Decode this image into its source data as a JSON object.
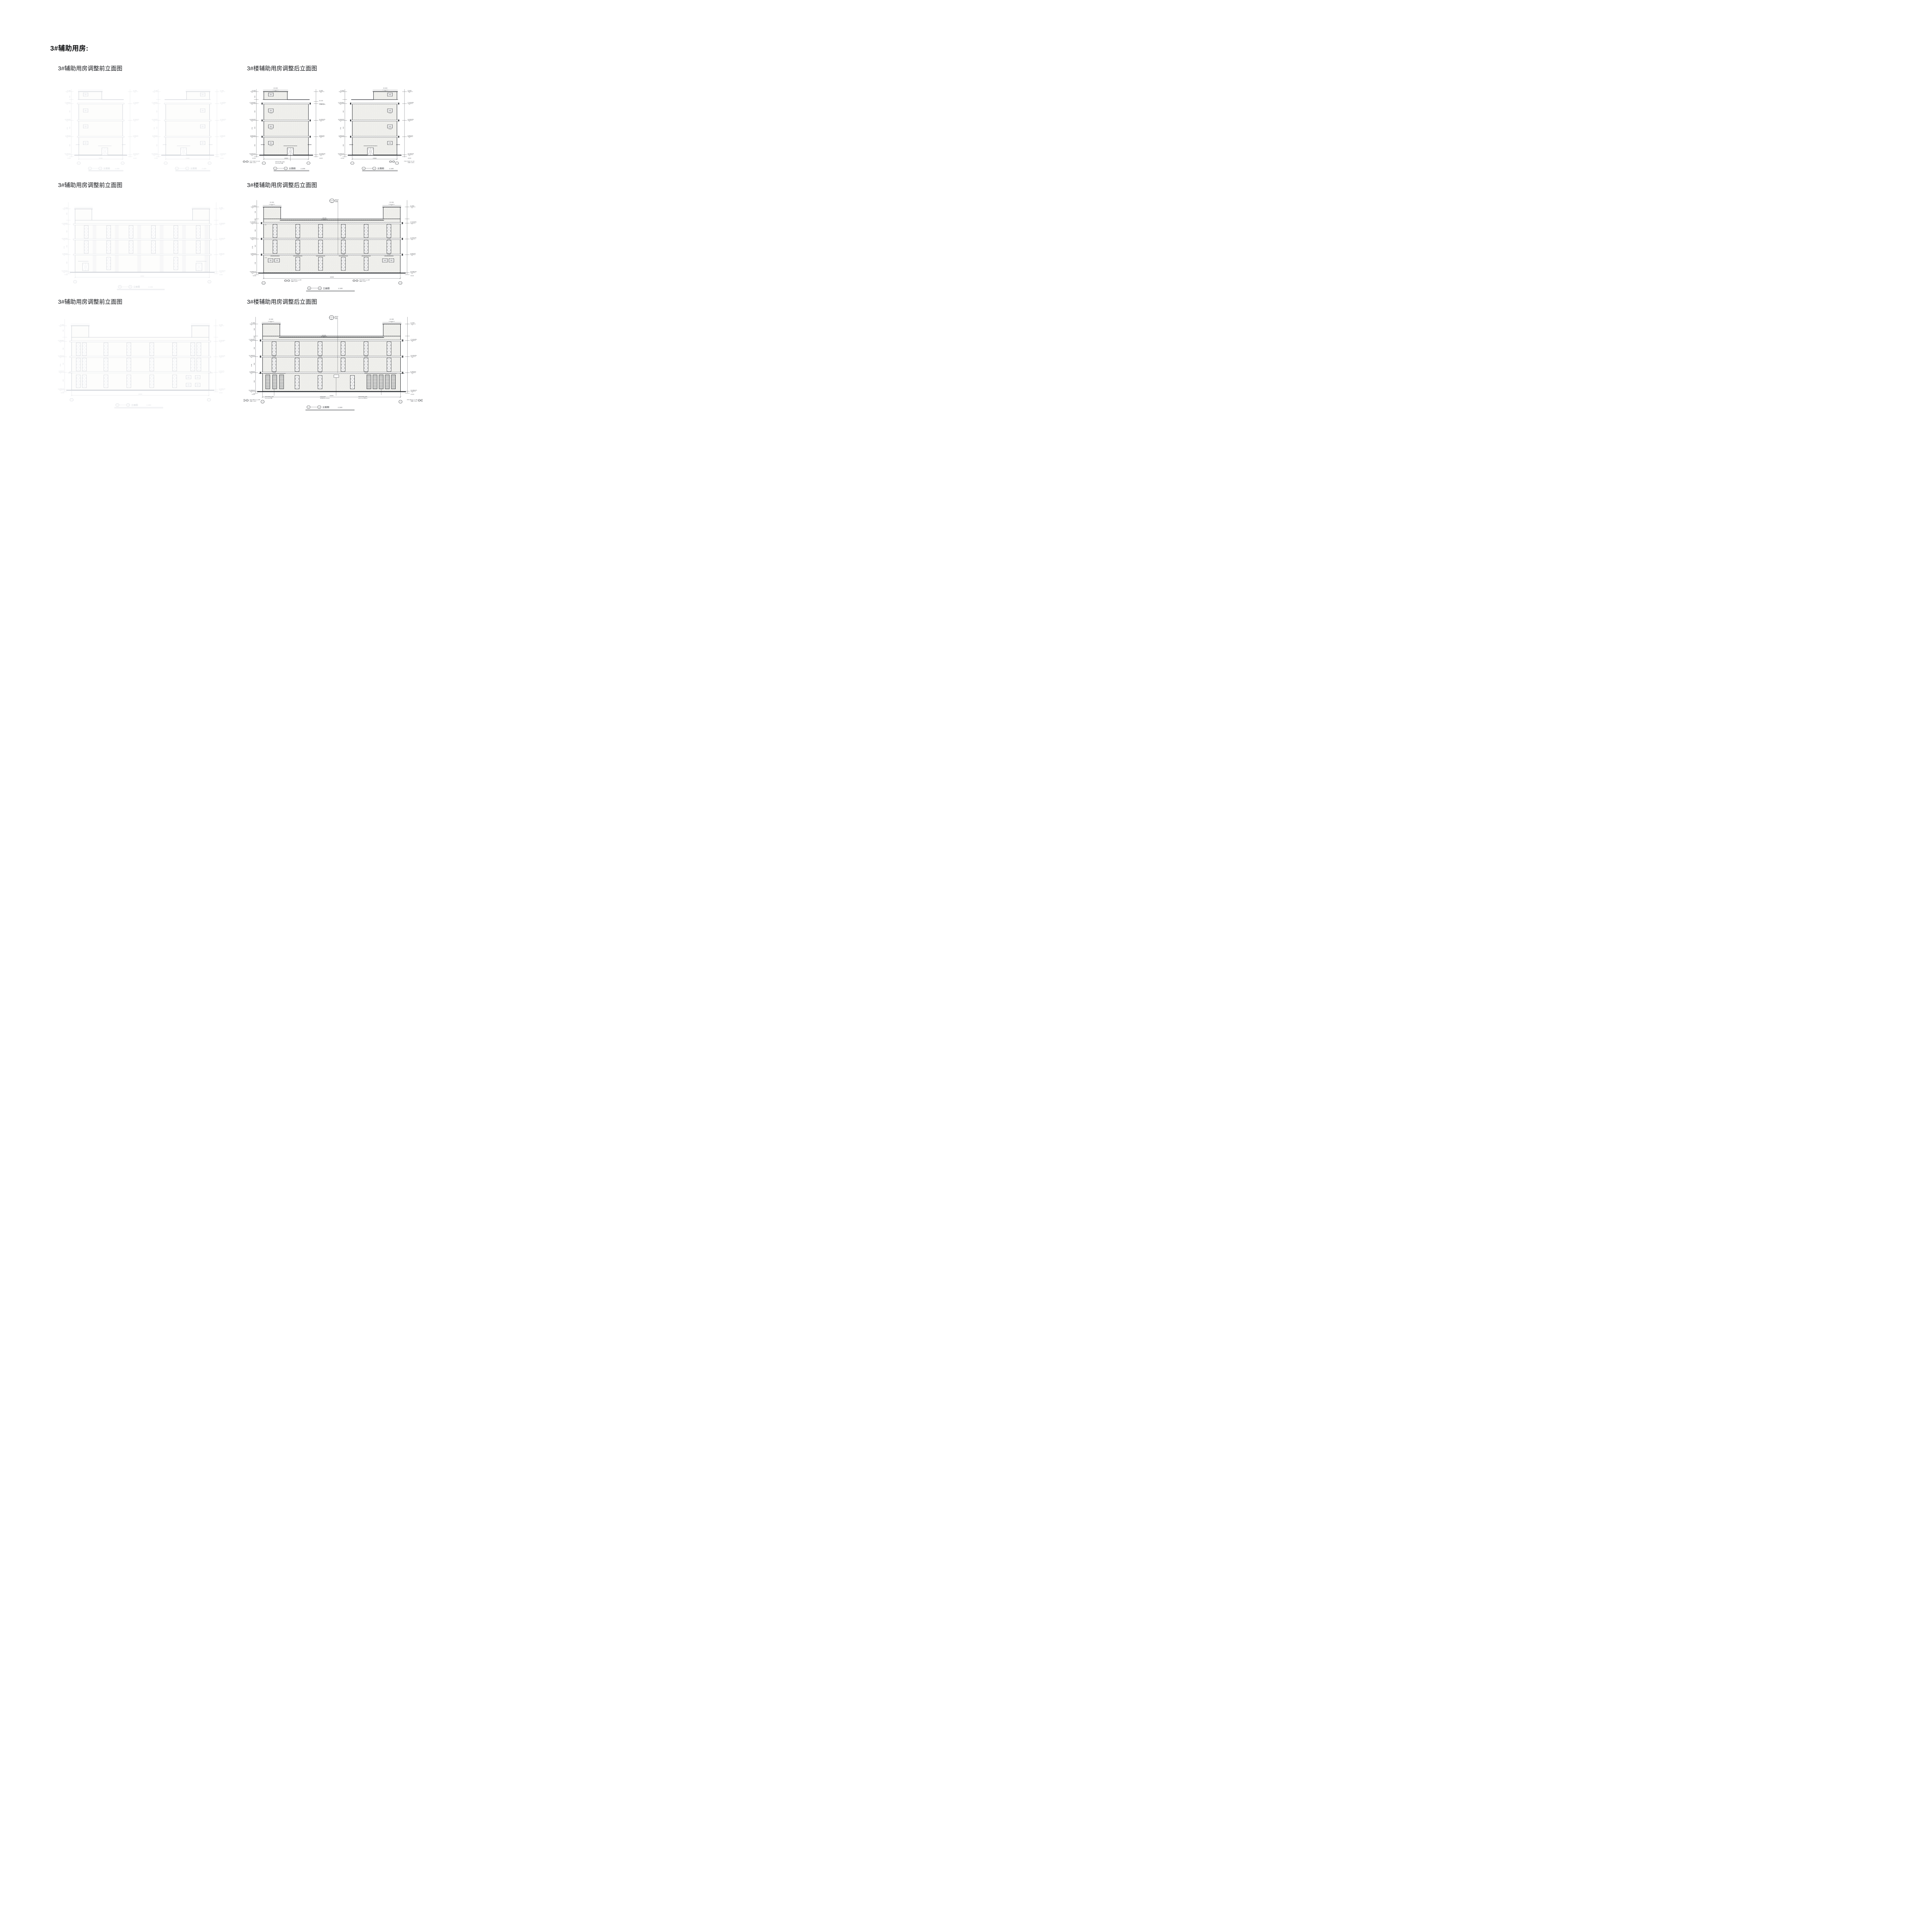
{
  "page": {
    "title": "3#辅助用房:"
  },
  "labels": {
    "before": "3#辅助用房调整前立面图",
    "after": "3#楼辅助用房调整后立面图"
  },
  "captions": {
    "r1a": {
      "from": "3-1",
      "to": "3-3"
    },
    "r1b": {
      "from": "3-3",
      "to": "3-1"
    },
    "r2": {
      "from": "3-6",
      "to": "3-4"
    },
    "r3": {
      "from": "3-4",
      "to": "3-6"
    },
    "text": "立面图",
    "scale": "1:100"
  },
  "anno": {
    "lv22400": "22.400",
    "lv21800": "21.800",
    "lv18100": "18.100",
    "lvRF": "17.600(RF)",
    "lv3F": "12.000(3F)",
    "lv2F": "6.400(2F)",
    "lv1F": "±0.000(1F)",
    "lvNeg": "-0.015",
    "d17750": "17750",
    "d4200": "4200",
    "d5600": "5600",
    "d5650": "5650",
    "d6400": "6400",
    "d14000": "14000",
    "d42000": "42000",
    "d1500": "1500",
    "d2700": "2700",
    "d400": "400",
    "d1000": "1000",
    "winTower": "C1504",
    "winWide": "C1540",
    "bub1": "3/22",
    "bub2": "1/21",
    "noteRail1": "栏杆柱 顶标高2.500 含网",
    "noteRail2": "详图集 11ZJ901",
    "noteAl": "铝合金百叶窗口(含网)",
    "noteCanopy": "5500x1800 雨篷",
    "noteAl2": "铝合金百叶窗",
    "notePanel": "消防联控箱 1650X800",
    "noteLouver": "4600x1500 距地300",
    "detailNo": "1",
    "detailDen": "11",
    "detailT1": "墙身大样",
    "detailT2": "详建施"
  }
}
